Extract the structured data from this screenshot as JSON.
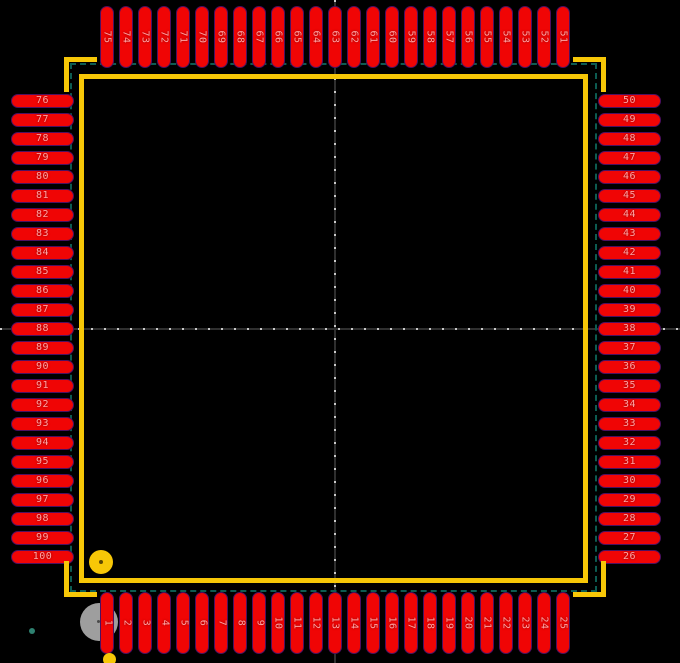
{
  "view": {
    "description": "PCB footprint canvas showing a 100-pin quad flat package",
    "pin_count": 100
  },
  "pins": {
    "top": [
      "75",
      "74",
      "73",
      "72",
      "71",
      "70",
      "69",
      "68",
      "67",
      "66",
      "65",
      "64",
      "63",
      "62",
      "61",
      "60",
      "59",
      "58",
      "57",
      "56",
      "55",
      "54",
      "53",
      "52",
      "51"
    ],
    "right": [
      "50",
      "49",
      "48",
      "47",
      "46",
      "45",
      "44",
      "43",
      "42",
      "41",
      "40",
      "39",
      "38",
      "37",
      "36",
      "35",
      "34",
      "33",
      "32",
      "31",
      "30",
      "29",
      "28",
      "27",
      "26"
    ],
    "bottom": [
      "1",
      "2",
      "3",
      "4",
      "5",
      "6",
      "7",
      "8",
      "9",
      "10",
      "11",
      "12",
      "13",
      "14",
      "15",
      "16",
      "17",
      "18",
      "19",
      "20",
      "21",
      "22",
      "23",
      "24",
      "25"
    ],
    "left": [
      "76",
      "77",
      "78",
      "79",
      "80",
      "81",
      "82",
      "83",
      "84",
      "85",
      "86",
      "87",
      "88",
      "89",
      "90",
      "91",
      "92",
      "93",
      "94",
      "95",
      "96",
      "97",
      "98",
      "99",
      "100"
    ]
  },
  "colors": {
    "background": "#000000",
    "pad_fill": "#f00505",
    "pad_outline": "#4d1060",
    "pad_number_text": "#ffa3a3",
    "silkscreen": "#f7c707",
    "courtyard": "#0d5c52",
    "crosshair_dark": "#2f2f2f",
    "crosshair_light": "#c9c9c9",
    "drill_marker": "#9e9e9e",
    "grid_dot": "#2e8170"
  }
}
